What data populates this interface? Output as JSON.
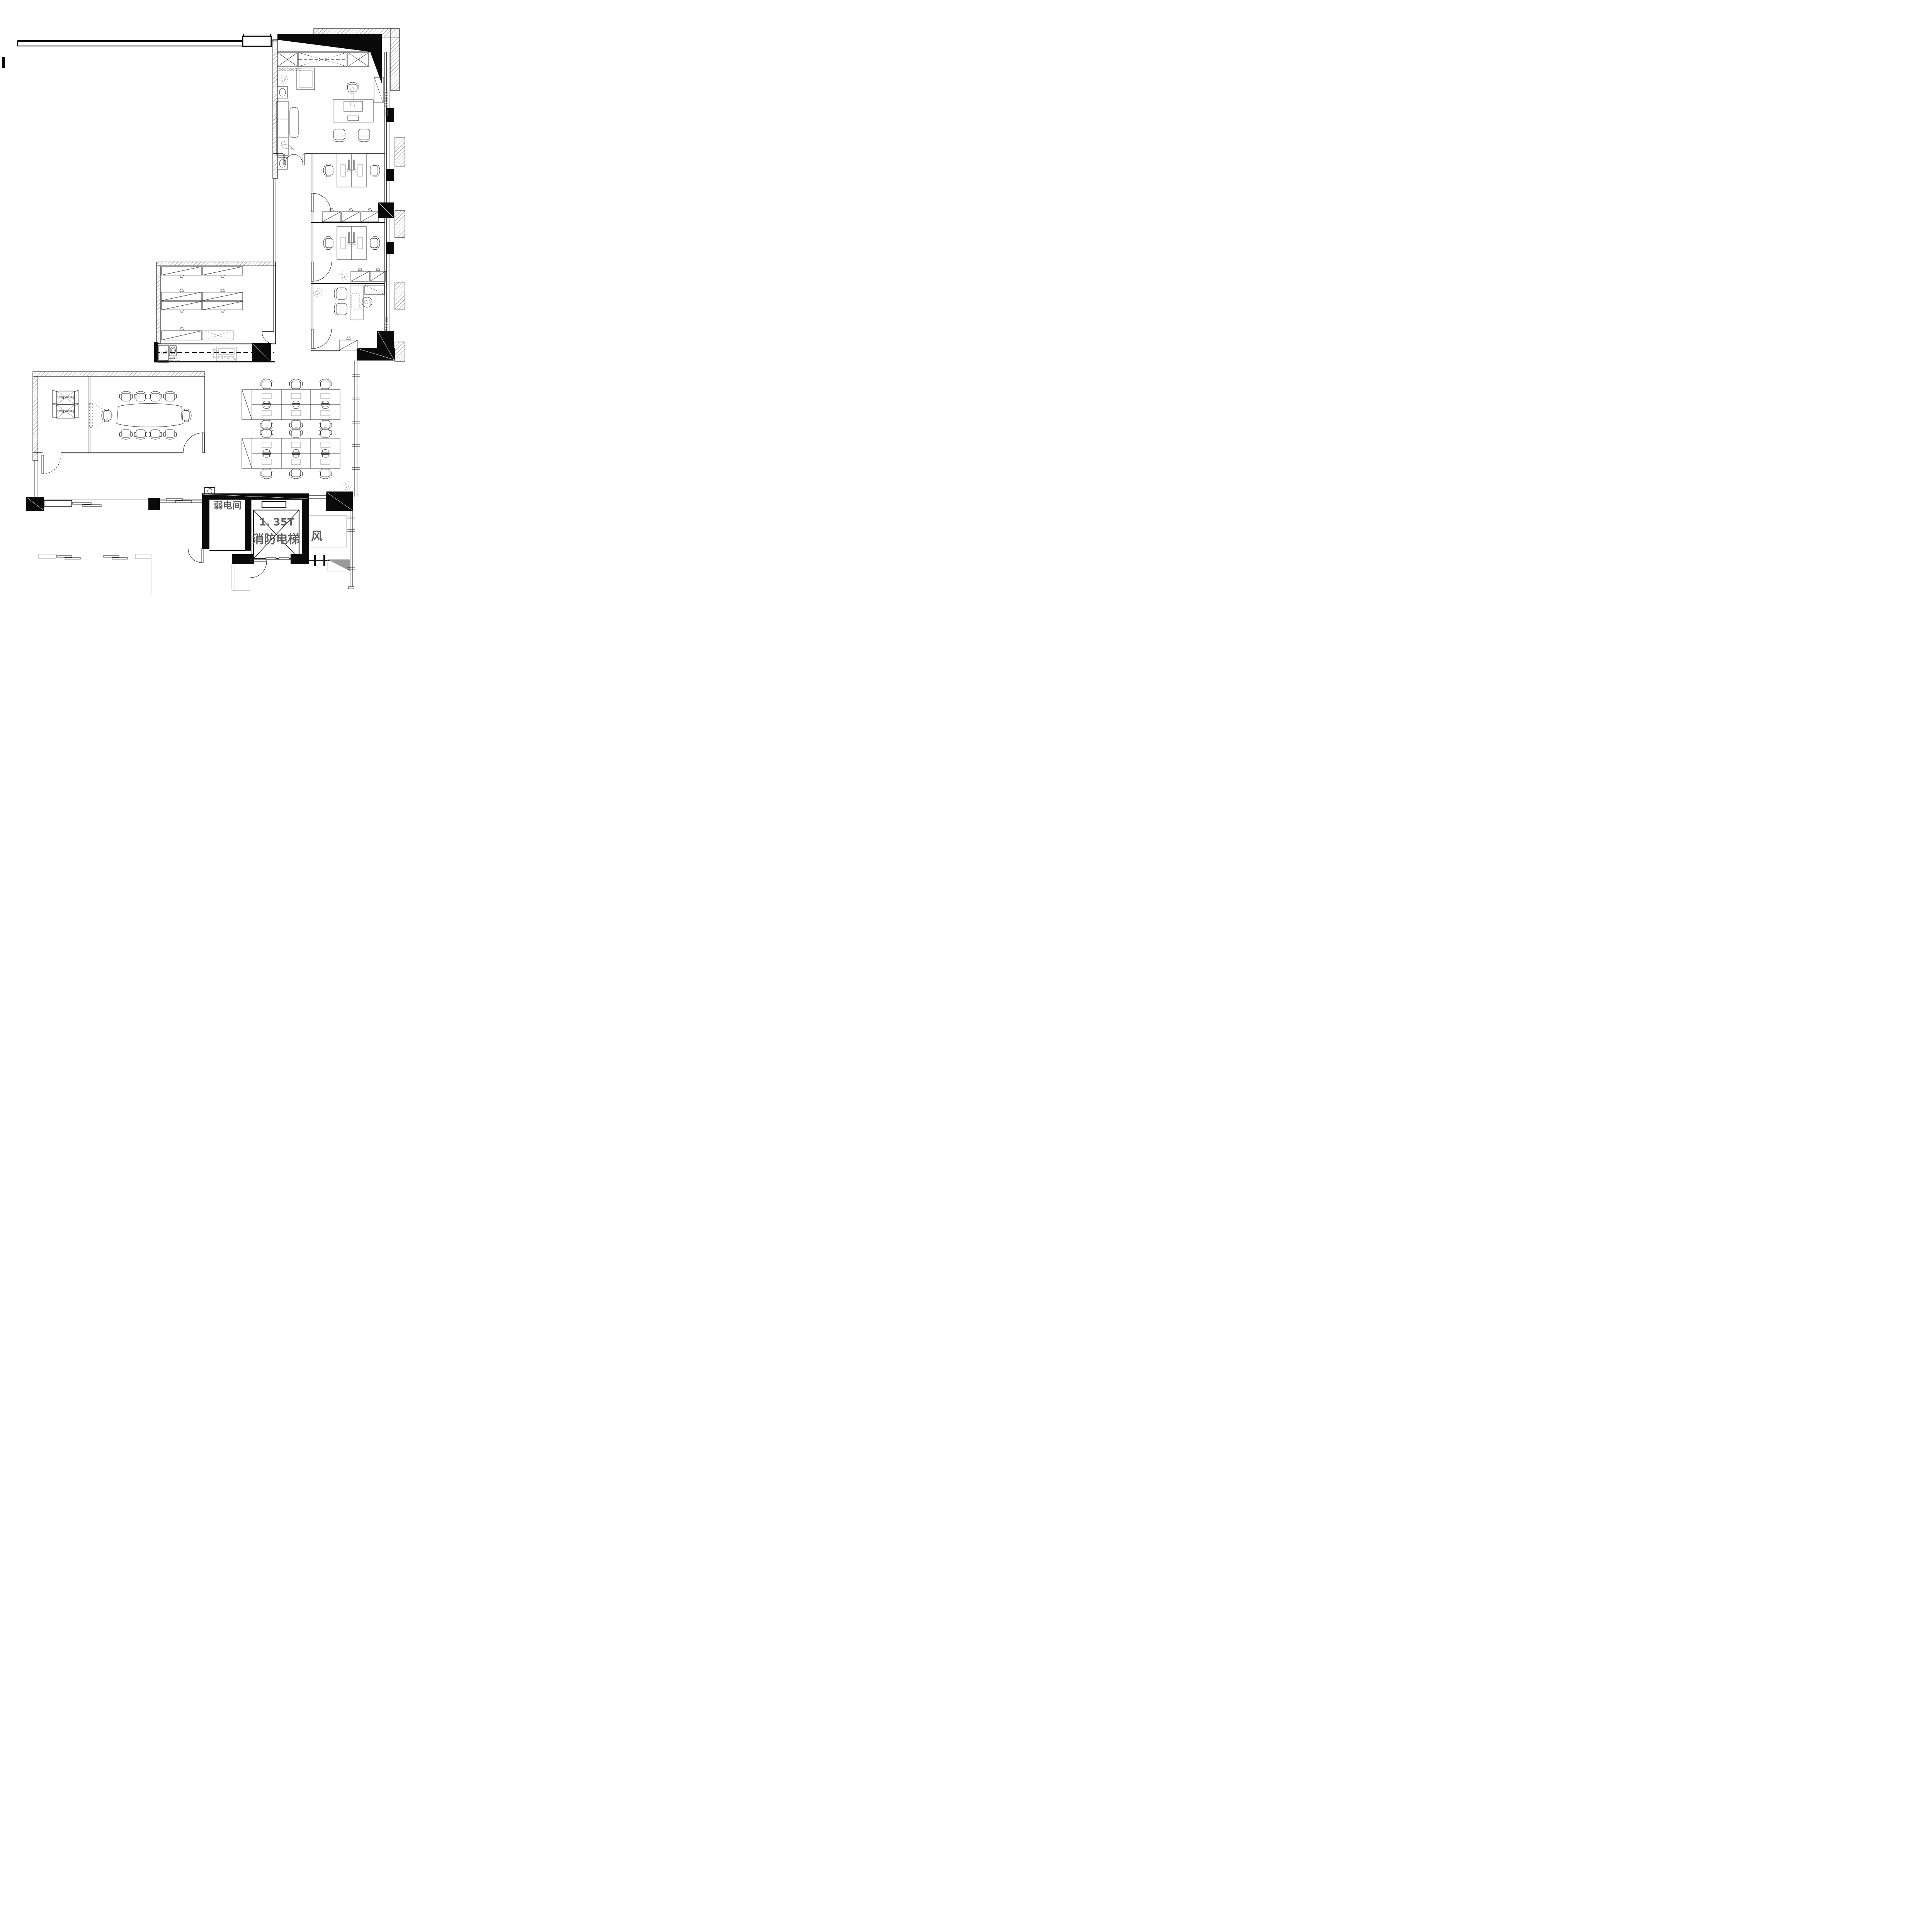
{
  "drawing": {
    "kind": "office floor plan (CAD line drawing, plan view)",
    "language": "Chinese / English annotations"
  },
  "labels": {
    "weak_current_room": "弱电间",
    "elevator_load": "1. 35T",
    "fire_elevator": "消防电梯",
    "air_shaft": "风",
    "fridge": "REF.",
    "water_dispenser_top": "WATER",
    "water_dispenser_bottom": "DISPENSER",
    "server_rack_a": "Server Rack",
    "server_rack_b": "Server Rack"
  },
  "colors": {
    "ink": "#111111",
    "wall_black": "#0a0a0a",
    "label_gray": "#5f5f5f",
    "light_gray": "#9a9a9a",
    "shaft_gray": "#999999",
    "paper": "#ffffff"
  }
}
